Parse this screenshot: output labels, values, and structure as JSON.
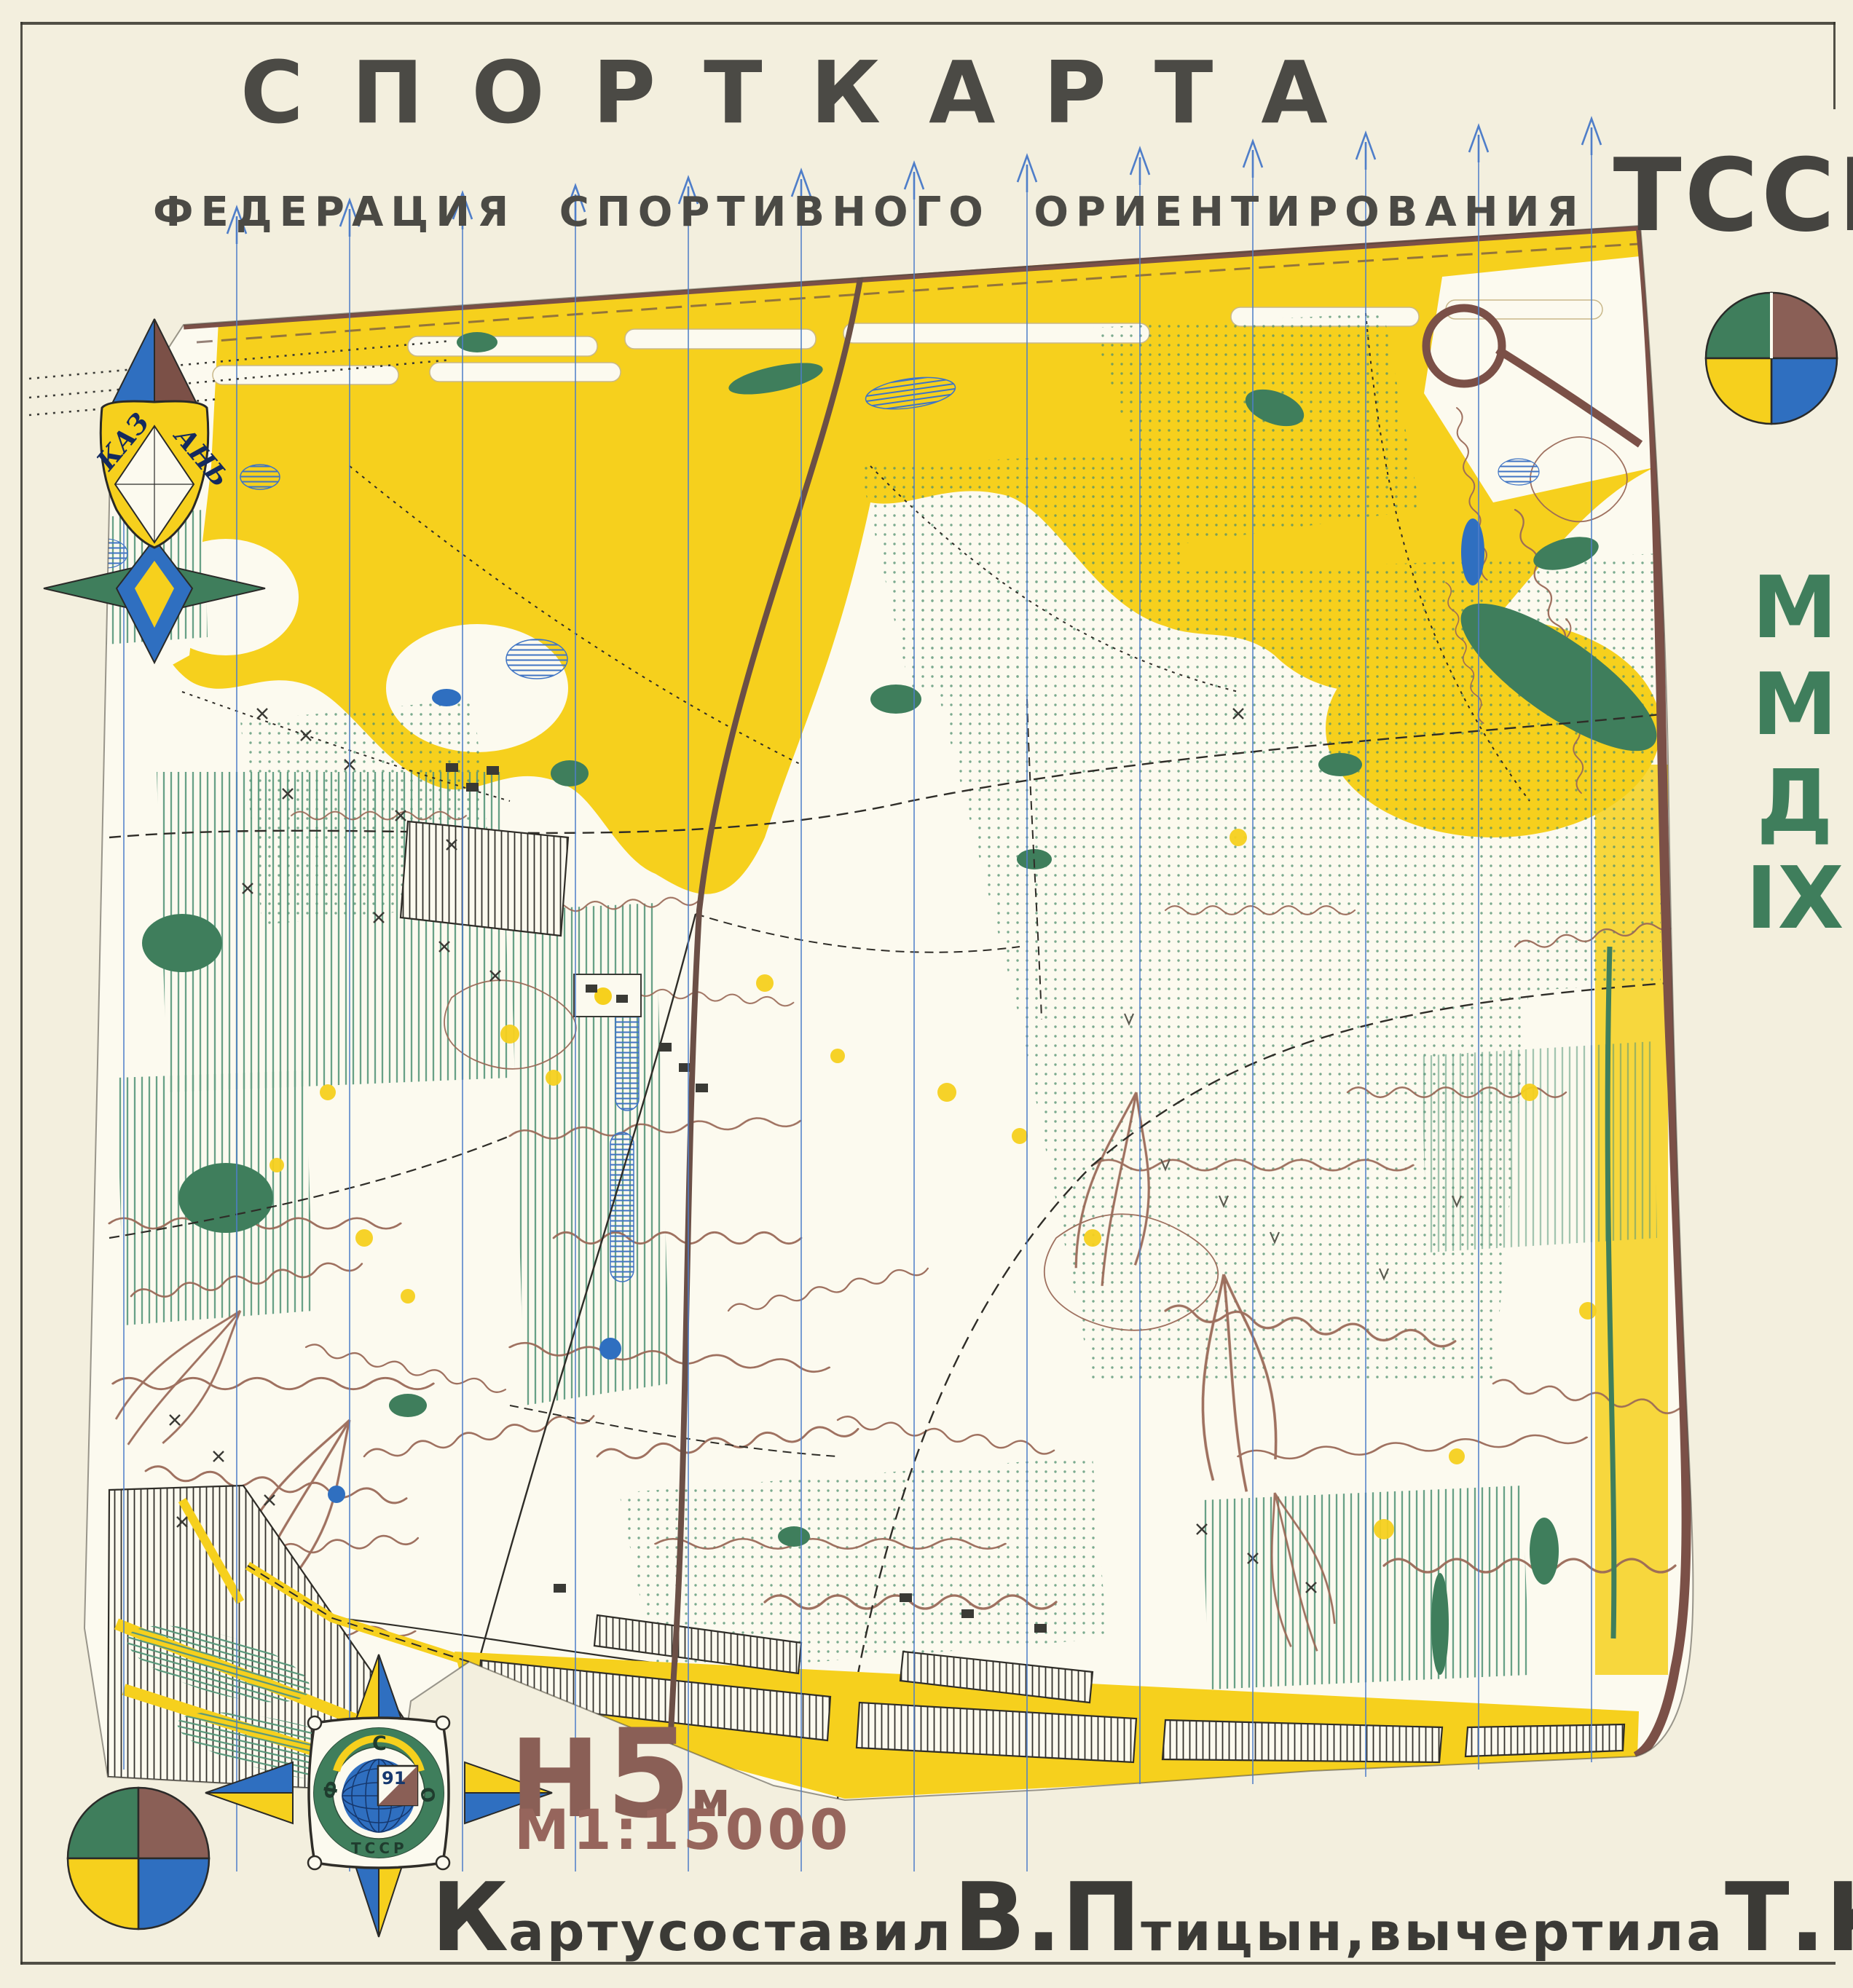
{
  "header": {
    "title": "СПОРТКАРТА",
    "subtitle": "ФЕДЕРАЦИЯ СПОРТИВНОГО ОРИЕНТИРОВАНИЯ",
    "org": "ТССР"
  },
  "side_label": {
    "l1": "М",
    "l2": "М",
    "l3": "Д",
    "l4": "IX"
  },
  "kazan_emblem": {
    "left": "КАЗ",
    "right": "АНЬ"
  },
  "compass_emblem": {
    "north": "С",
    "west": "Ф",
    "east": "О",
    "bottom": "ТССР",
    "year": "91"
  },
  "scale": {
    "h_label": "Н",
    "h_value": "5",
    "h_unit": "м",
    "ratio": "М1:15000"
  },
  "credits": {
    "p1": "К",
    "p2": "арту",
    "p3": "составил",
    "p4": "В.П",
    "p5": "тицын",
    "p6": ",",
    "p7": "вычертила",
    "p8": "Т.К",
    "p9": "ушнерова"
  },
  "palette": {
    "paper": "#f3efde",
    "map_white": "#fcfaef",
    "open_yellow": "#f6d01d",
    "forest_green": "#3f7e5c",
    "water_blue": "#2f6fc0",
    "road_brown": "#7b5047",
    "contour_brown": "#9a6a58",
    "meridian_blue": "#4f7ec9",
    "title_ink": "#4b4a45",
    "scale_brown": "#8a5f56"
  }
}
